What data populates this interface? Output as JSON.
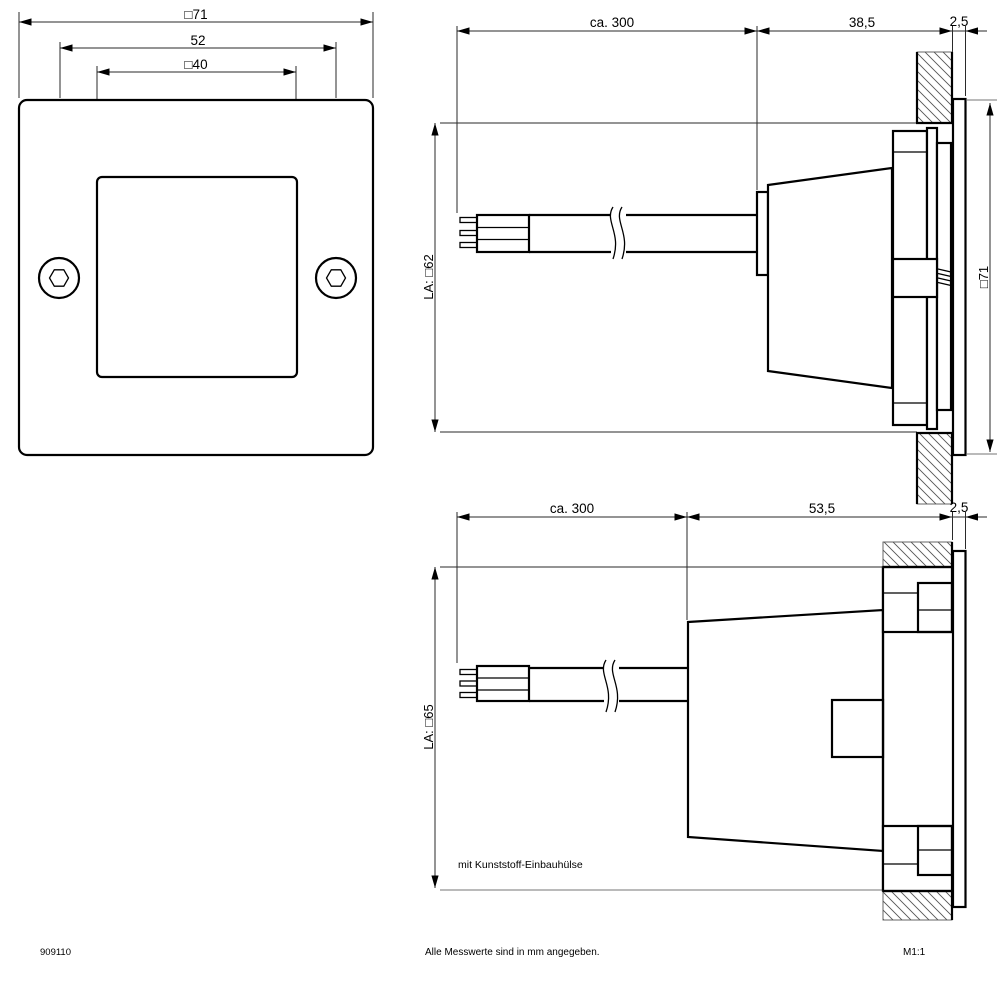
{
  "drawing": {
    "colors": {
      "line": "#000000",
      "background": "#ffffff",
      "extension_line": "#909090"
    },
    "front_view": {
      "outer_width": "□71",
      "screw_spacing": "52",
      "window_width": "□40"
    },
    "top_view": {
      "cable_length": "ca. 300",
      "recess_depth": "38,5",
      "bezel_thickness": "2,5",
      "cutout": "LA: □62",
      "overall_height": "□71"
    },
    "bottom_view": {
      "cable_length": "ca. 300",
      "recess_depth": "53,5",
      "bezel_thickness": "2,5",
      "cutout": "LA: □65",
      "note": "mit Kunststoff-Einbauhülse"
    },
    "footer": {
      "article_number": "909110",
      "units_note": "Alle Messwerte sind in mm angegeben.",
      "scale": "M1:1"
    }
  }
}
